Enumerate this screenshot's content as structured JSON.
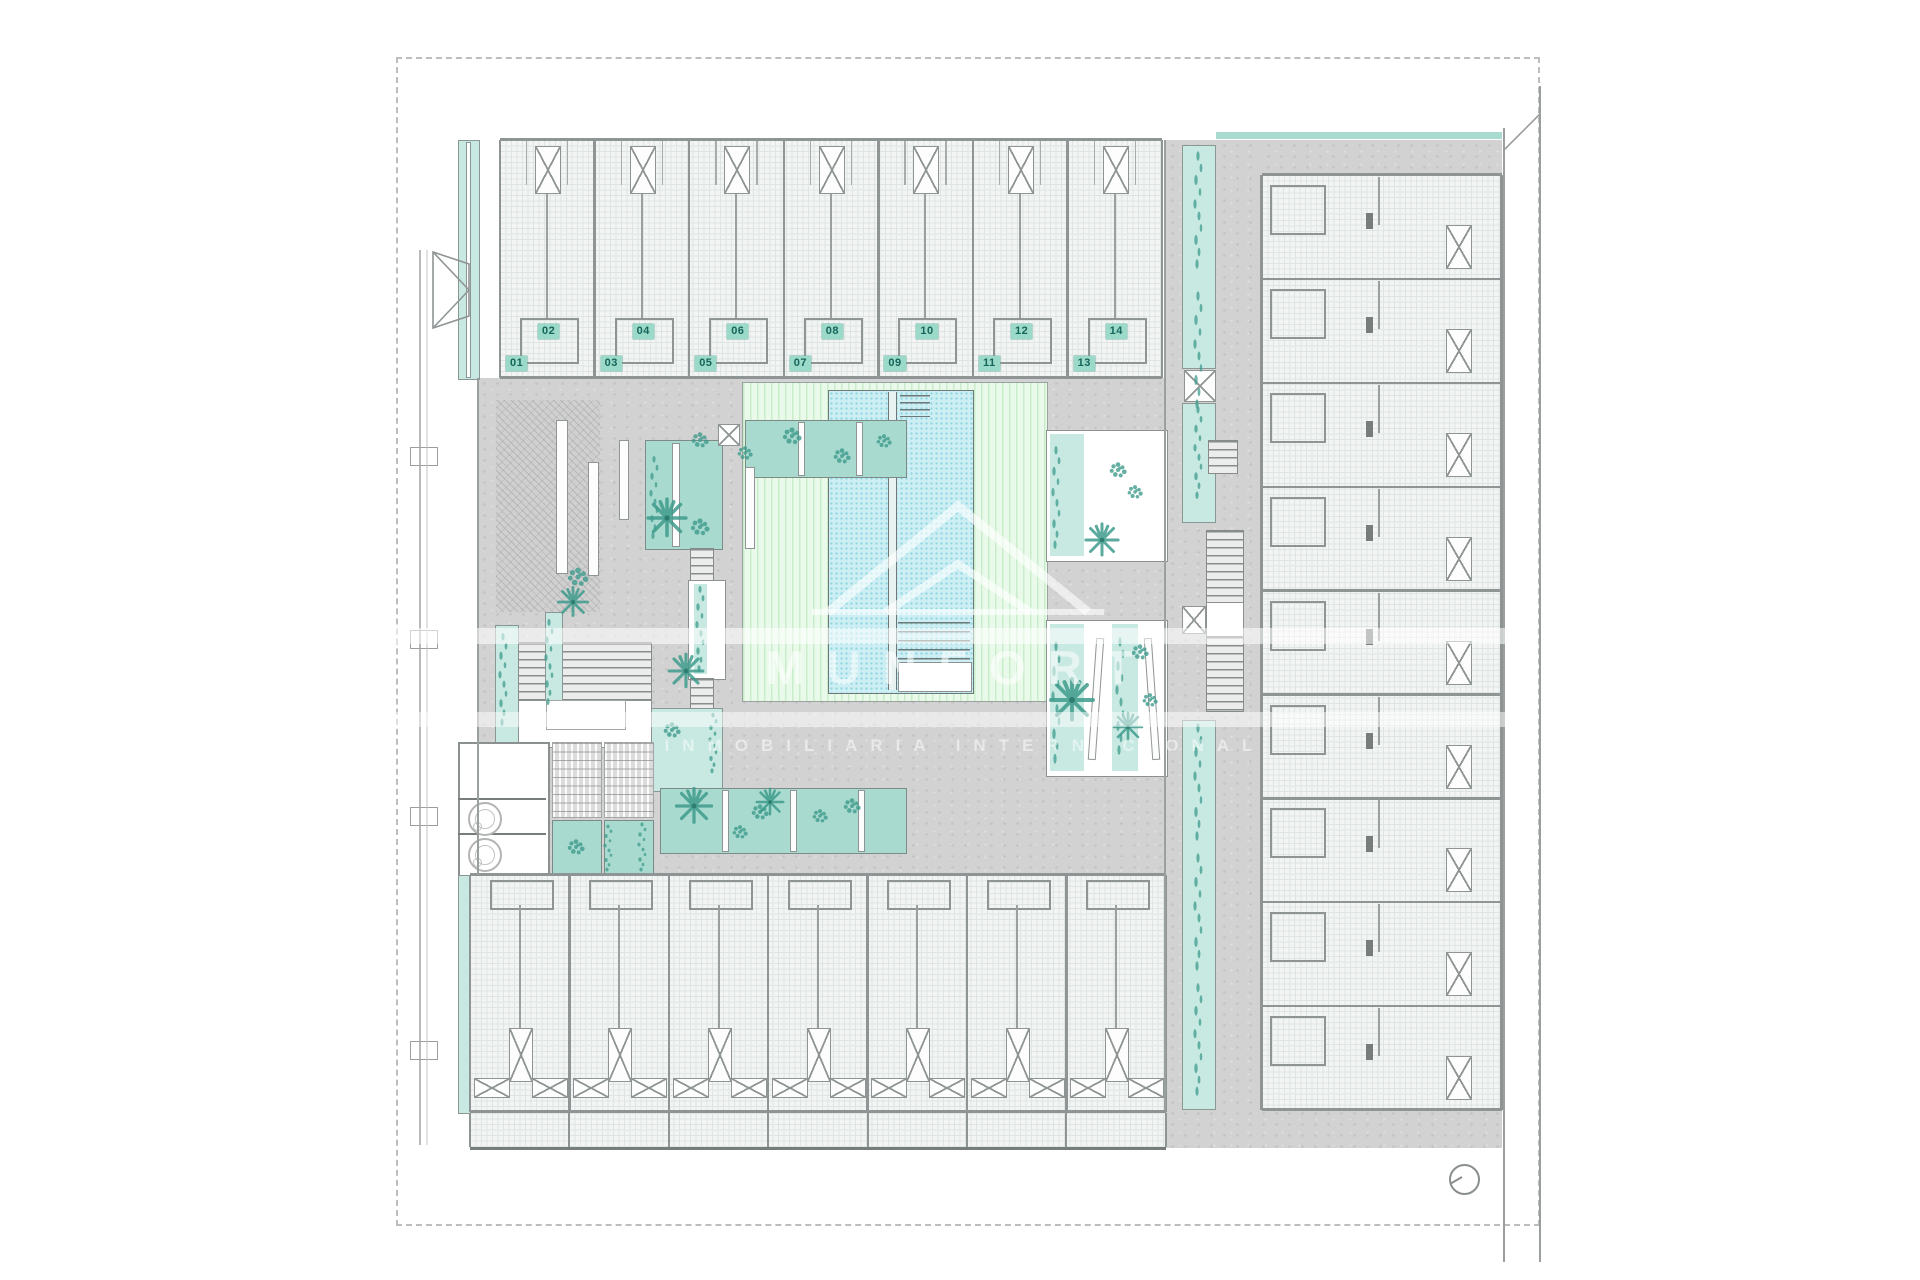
{
  "meta": {
    "drawing_type": "architectural ground floor site plan",
    "subject": "residential complex with central pool courtyard"
  },
  "units": {
    "top": [
      "01",
      "02",
      "03",
      "04",
      "05",
      "06",
      "07",
      "08",
      "09",
      "10",
      "11",
      "12",
      "13",
      "14"
    ]
  },
  "watermark": {
    "brand": "MUNFORT",
    "tagline": "INMOBILIARIA INTERNACIONAL"
  },
  "symbols": {
    "north": "north-indicator-icon",
    "laundry": "washing-machine-icon",
    "elevator": "elevator-shaft-icon",
    "stairs": "staircase-icon",
    "pool": "swimming-pool",
    "deck": "pool-deck",
    "planter": "planter-with-plants"
  },
  "colors": {
    "wall": "#8f9494",
    "wall_dark": "#6f7878",
    "floor": "#f3f5f4",
    "grid": "#dfe5e2",
    "concrete": "#d2d2d2",
    "deck": "#eafaea",
    "deck_stripe": "#c9edcb",
    "pool": "#cdeff4",
    "pool_dot": "#8ed6e0",
    "planter": "#a9dacf",
    "planter_light": "#c7e9e1",
    "plant": "#3f9c8d",
    "badge_bg": "#9bd9c8",
    "badge_text": "#15655a",
    "dash": "#bdbdbd"
  }
}
